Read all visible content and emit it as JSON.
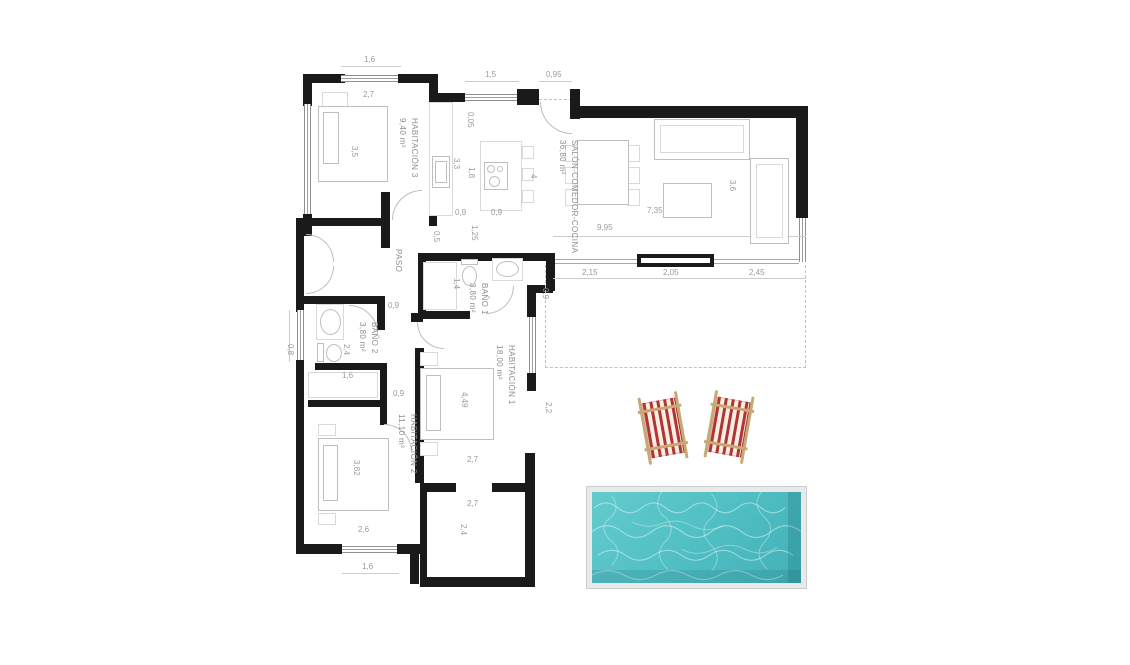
{
  "rooms": {
    "hab3": {
      "name": "HABITACIÓN 3",
      "area": "9,40 m²"
    },
    "salon": {
      "name": "SALÓN-COMEDOR-COCINA",
      "area": "36,80 m²"
    },
    "paso": {
      "name": "PASO",
      "area": ""
    },
    "bano1": {
      "name": "BAÑO 1",
      "area": "3,80 m²"
    },
    "bano2": {
      "name": "BAÑO 2",
      "area": "3,80 m²"
    },
    "hab1": {
      "name": "HABITACIÓN 1",
      "area": "18,00 m²"
    },
    "hab2": {
      "name": "HABITACIÓN 2",
      "area": "11,10 m²"
    }
  },
  "dims": {
    "top_window_hab3": "1,6",
    "hab3_width": "2,7",
    "hab3_depth": "3,5",
    "kitchen_window": "1,5",
    "entrance_width": "0,95",
    "kitchen_offset": "0,05",
    "kitchen_counter_len": "3,3",
    "island_len": "1,8",
    "kitchen_depth": "4",
    "island_gap": "0,9",
    "island_width": "0,9",
    "kitchen_pass": "1,25",
    "paso_opening": "0,5",
    "salon_len_total": "9,95",
    "salon_len_inner": "7,35",
    "salon_depth": "3,6",
    "facade_seg1": "2,15",
    "facade_seg2": "2,05",
    "facade_seg3": "2,45",
    "terrace_offset": "0,9",
    "bano1_width": "1,4",
    "bano2_door": "0,9",
    "bano2_depth": "2,4",
    "bano2_window": "0,8",
    "closet_width": "1,6",
    "hab2_door": "0,9",
    "hab2_bed_side": "3,82",
    "hab2_width": "2,6",
    "hab2_window": "1,6",
    "hab1_length": "4,49",
    "hab1_width": "2,7",
    "hab1_window_side": "2,2",
    "porch_width": "2,7",
    "porch_depth": "2,4"
  },
  "palette": {
    "wall": "#1a1a1a",
    "dim_text": "#9a9a9a",
    "label_text": "#8d8d8d",
    "pool_water": "#4fbec3",
    "pool_frame": "#e9e9e9",
    "chair_red": "#b23434",
    "chair_wood": "#c9a876"
  }
}
